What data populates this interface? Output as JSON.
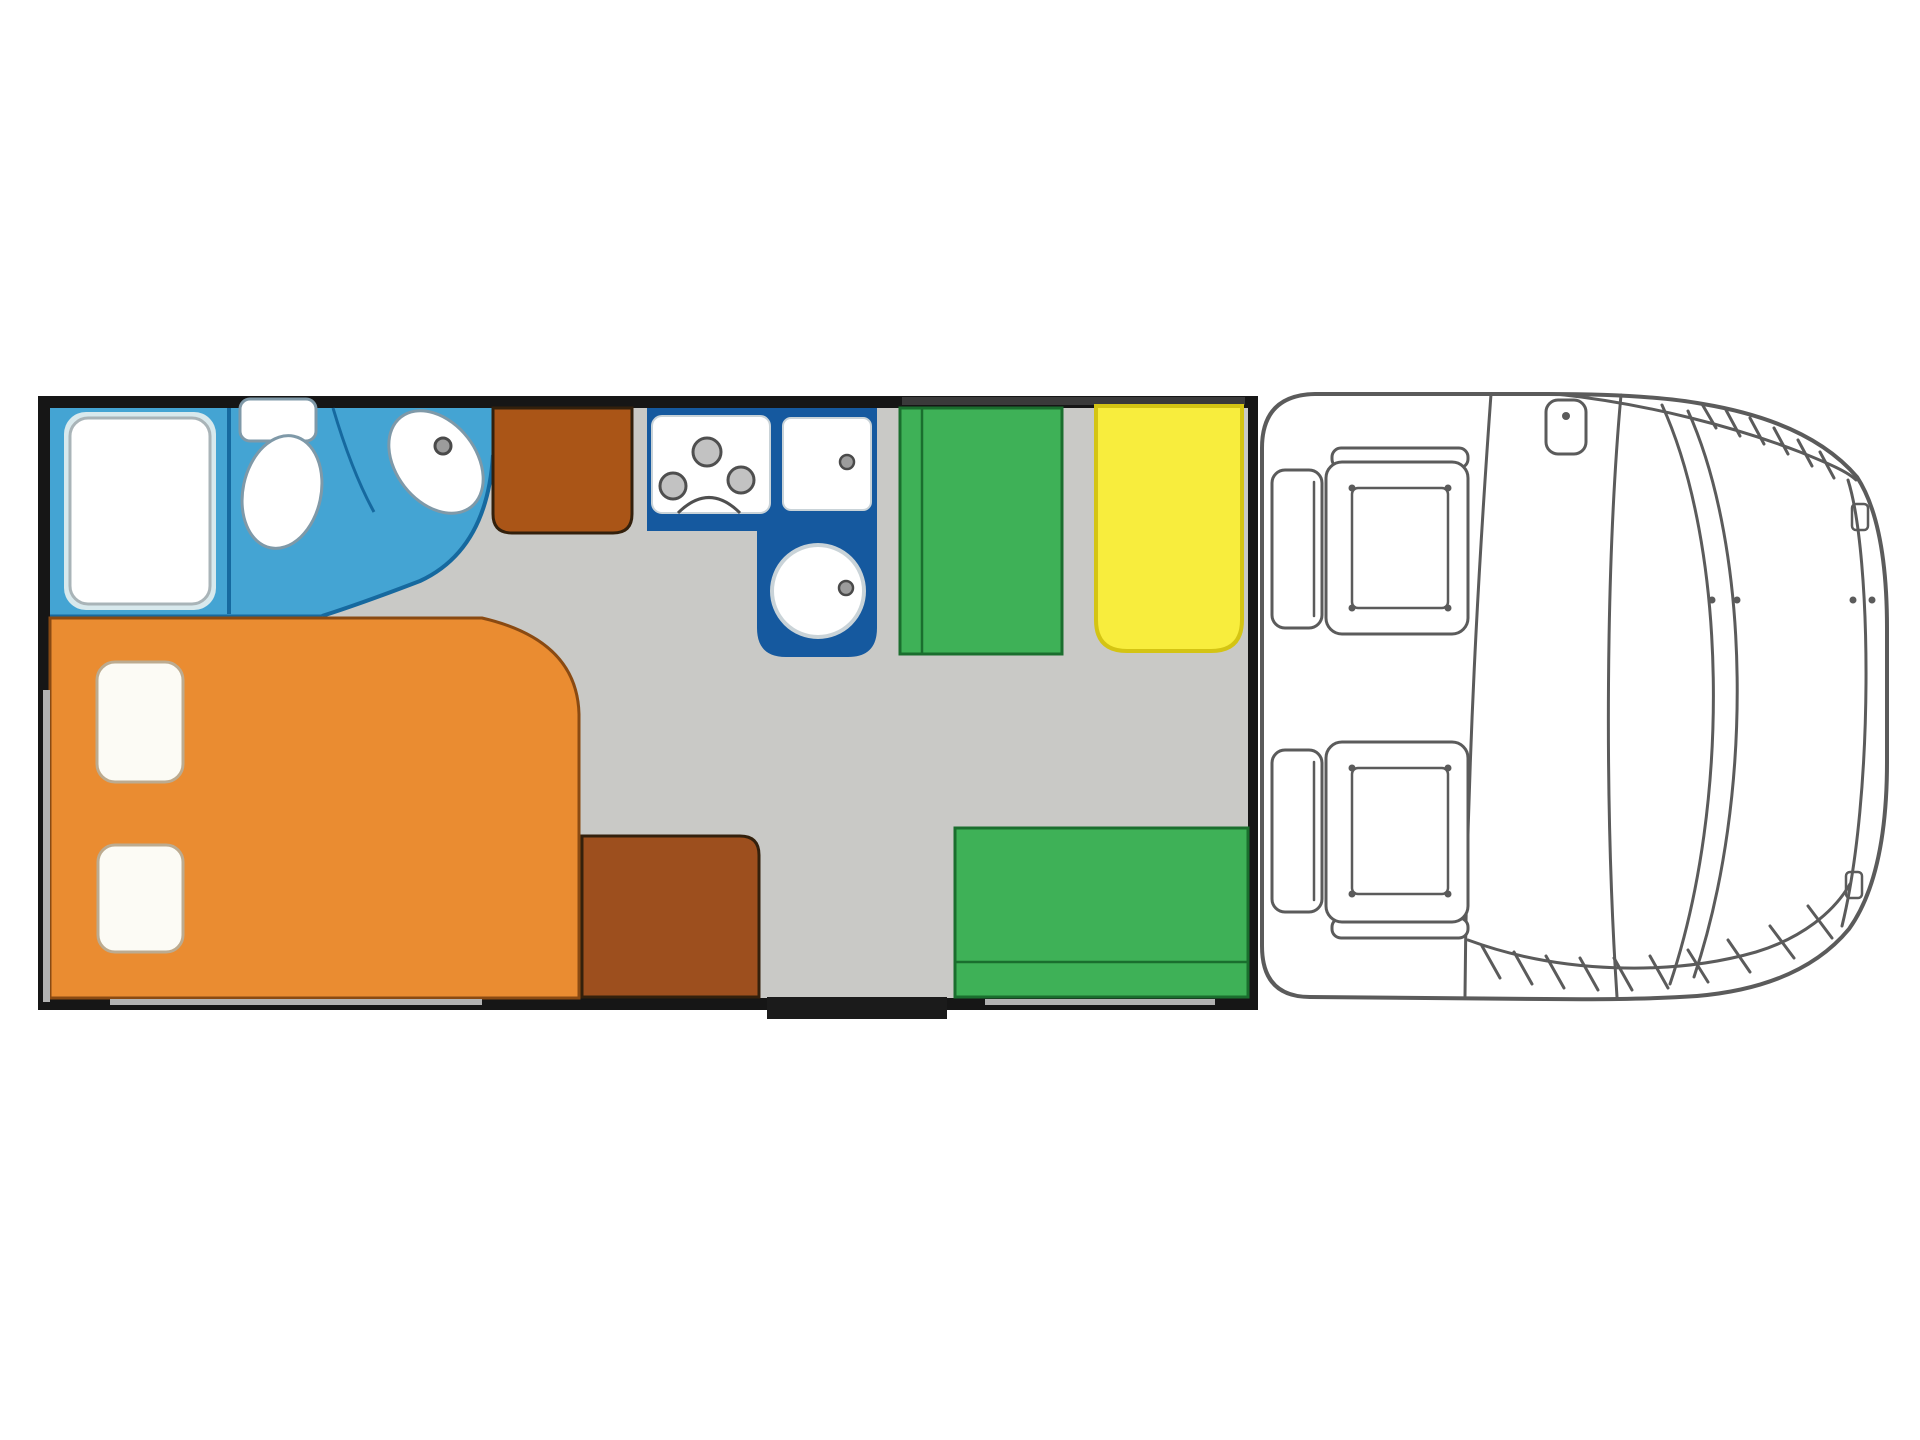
{
  "diagram": {
    "kind": "motorhome-floorplan",
    "orientation": "cab-on-right",
    "counts": {
      "pillows": 2,
      "hob_burners": 3,
      "cab_seats": 2,
      "dinette_benches": 2
    },
    "components": [
      "outer-walls",
      "bathroom",
      "shower-tray",
      "toilet",
      "washbasin",
      "front-wardrobe",
      "kitchen-block",
      "hob",
      "worktop",
      "round-sink",
      "dinette-bench-front",
      "dinette-table",
      "dinette-bench-rear",
      "rear-wardrobe",
      "french-bed",
      "pillows",
      "entry-step",
      "wall-windows",
      "cab-body",
      "driver-seat",
      "passenger-seat",
      "rear-view-mirror",
      "windscreen",
      "bumper"
    ]
  },
  "colors": {
    "background": "#ffffff",
    "wall": "#161616",
    "wall_window_light": "#b2b2b2",
    "wall_window_dark": "#3a3a3a",
    "floor": "#c9c9c6",
    "bathroom": "#44a4d3",
    "bathroom_line": "#16699f",
    "shower_outer": "#d8e9ed",
    "shower_stroke": "#a9b4b8",
    "fixture_stroke": "#7f99a8",
    "white": "#ffffff",
    "kitchen": "#15599f",
    "appliance_stroke": "#c9d3d8",
    "burner_fill": "#c2c2c2",
    "burner_stroke": "#4f4f4f",
    "knob": "#9c9c9c",
    "knob_stroke": "#4a4a4a",
    "bed": "#ea8c31",
    "bed_stroke": "#8a4a12",
    "pillow": "#fcfbf5",
    "pillow_stroke": "#bcab90",
    "cabinet_front": "#aa5517",
    "cabinet_rear": "#9d4f1e",
    "cabinet_stroke": "#33200c",
    "bench": "#3eb157",
    "bench_stroke": "#1a6e2e",
    "table": "#f8ed3d",
    "table_stroke": "#d4c413",
    "step": "#1b1b1b",
    "cab_line": "#5b5b5b"
  }
}
